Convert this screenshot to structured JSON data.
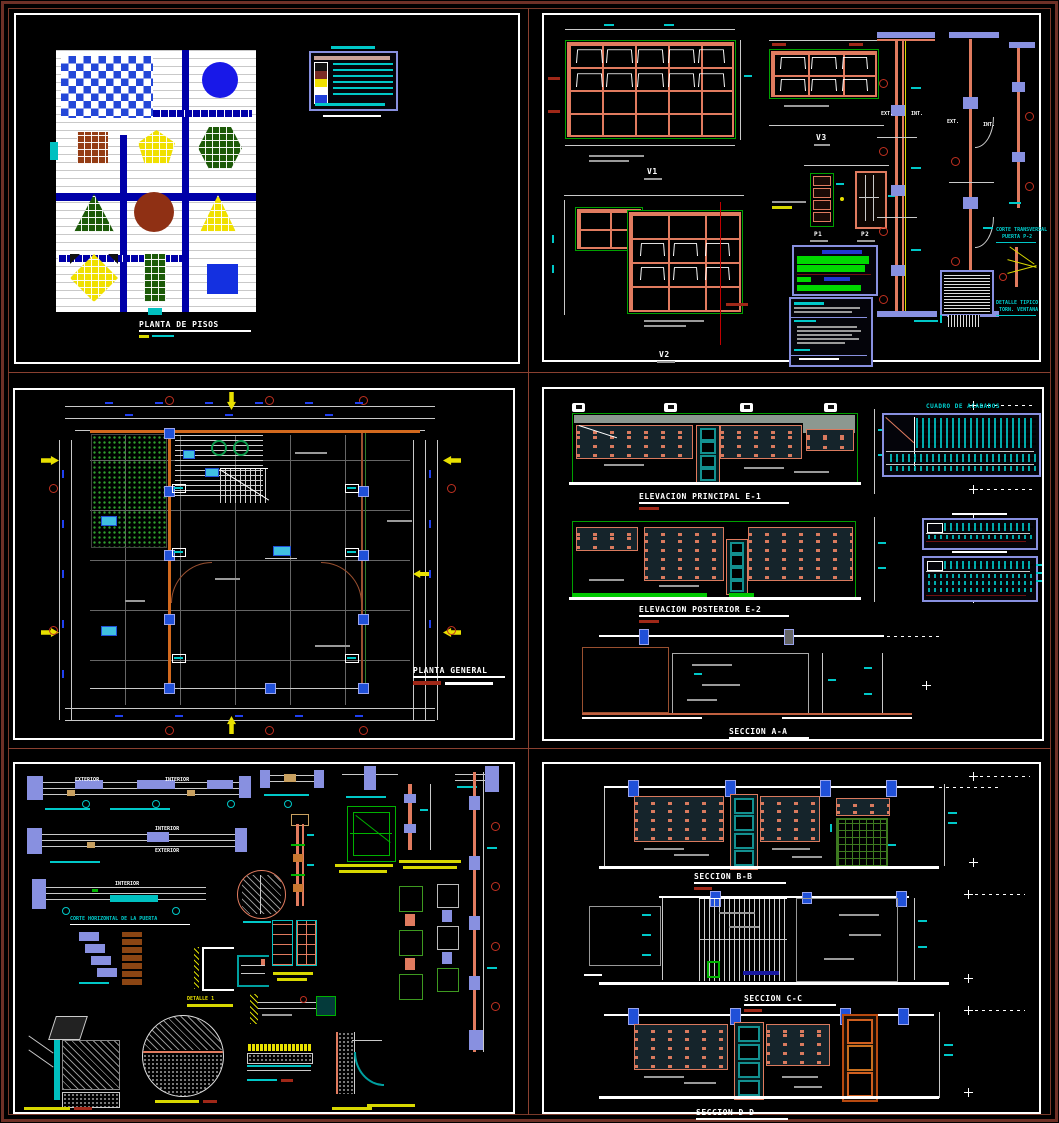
{
  "page": {
    "background": "#000000",
    "frame_color": "#7A3A2A",
    "sheet_border": "#FFFFFF"
  },
  "colors": {
    "cad_blue_band": "#0000A8",
    "checker_blue": "#2447D8",
    "salmon": "#E07B5F",
    "green": "#00B400",
    "dark_green": "#1C5A08",
    "brown": "#943C14",
    "yellow": "#F0E000",
    "periwinkle": "#8890E0",
    "cyan": "#00C8C8",
    "dim_blue_text": "#2040F0",
    "maroon_frame": "#8A4030",
    "teal_door": "#139090",
    "orange_door": "#D06020"
  },
  "sheet1": {
    "title": "PLANTA DE PISOS",
    "legend_swatches": [
      "#111111",
      "#7B2D26",
      "#F0E000",
      "#FFFFFF",
      "#1F3FD8"
    ],
    "shapes": [
      "checkerboard",
      "blue-circle",
      "brown-grid-square",
      "yellow-pentagon",
      "green-hexagon",
      "green-triangle",
      "brown-circle",
      "yellow-triangle",
      "yellow-diamond",
      "green-grid-rect",
      "blue-square"
    ]
  },
  "sheet2": {
    "v1": "V1",
    "v2": "V2",
    "v3": "V3",
    "p1": "P1",
    "p2": "P2",
    "ext": "EXT.",
    "int_": "INT.",
    "corte_title": "CORTE TRANSVERSAL",
    "corte_sub": "PUERTA P-2",
    "det_title": "DETALLE TIPICO",
    "det_sub": "TORN. VENTANA"
  },
  "sheet3": {
    "title": "PLANTA GENERAL"
  },
  "sheet4": {
    "elev1": "ELEVACION PRINCIPAL  E-1",
    "elev2": "ELEVACION POSTERIOR  E-2",
    "secAA": "SECCION A-A",
    "cuadro": "CUADRO DE ACABADOS"
  },
  "sheet5": {
    "interior": "INTERIOR",
    "exterior": "EXTERIOR",
    "corte_horizontal": "CORTE HORIZONTAL DE LA PUERTA",
    "detalle1": "DETALLE 1"
  },
  "sheet6": {
    "secBB": "SECCION B-B",
    "secCC": "SECCION C-C",
    "secDD": "SECCION D-D"
  }
}
